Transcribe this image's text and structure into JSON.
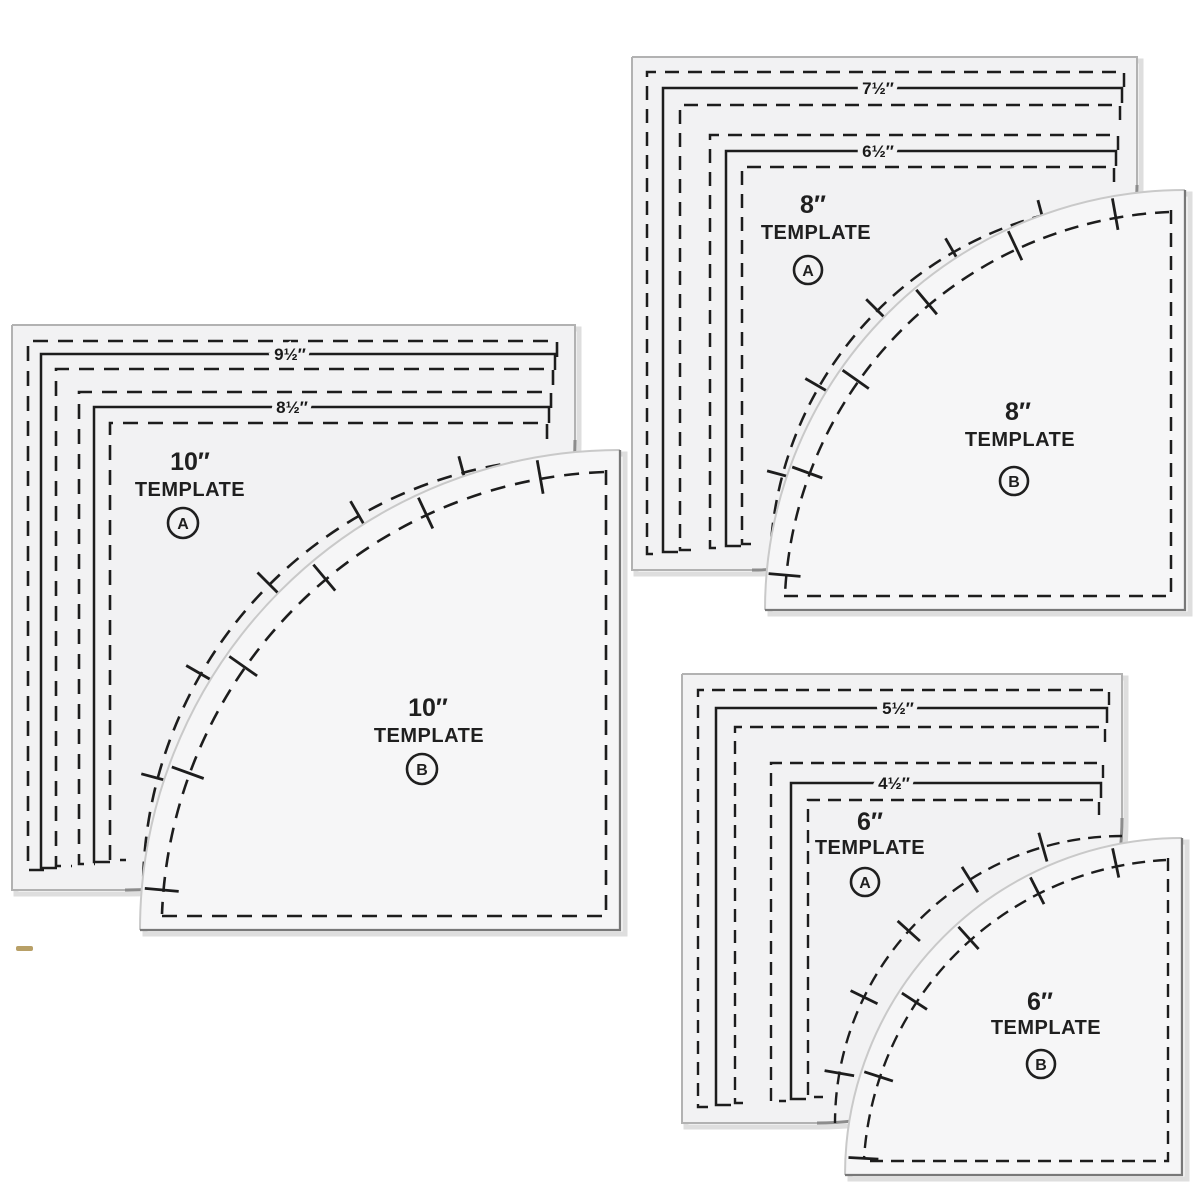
{
  "image_type": "product photo of acrylic quilting curve template set",
  "labels": {
    "template_word": "TEMPLATE",
    "letter_a": "A",
    "letter_b": "B"
  },
  "sets": [
    {
      "size": "10″",
      "ruler": [
        "9½″",
        "8½″"
      ]
    },
    {
      "size": "8″",
      "ruler": [
        "7½″",
        "6½″"
      ]
    },
    {
      "size": "6″",
      "ruler": [
        "5½″",
        "4½″"
      ]
    }
  ],
  "colors": {
    "background": "#ffffff",
    "print": "#1d1d1d",
    "acrylic_fill": "#f2f2f3",
    "edge_light": "#b2b2b2",
    "edge_dark": "#787878",
    "bevel": "#dedede",
    "artifact": "#ab8f4c"
  }
}
